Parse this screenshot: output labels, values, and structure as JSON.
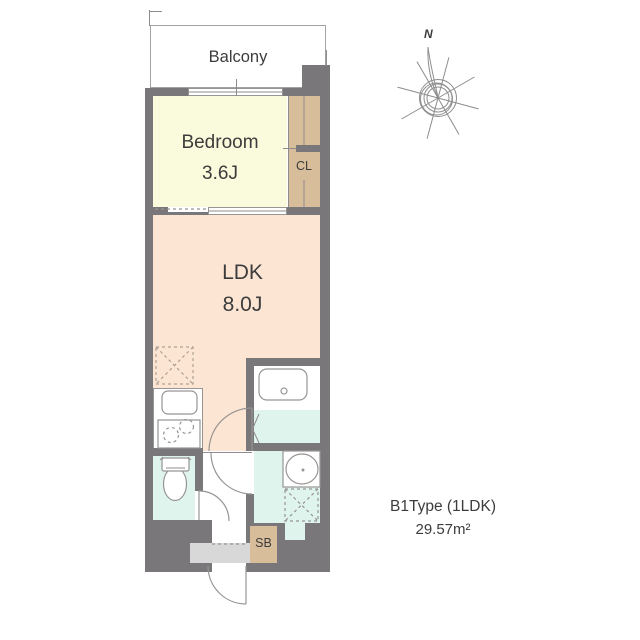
{
  "plan": {
    "balcony_label": "Balcony",
    "bedroom_label": "Bedroom",
    "bedroom_size": "3.6J",
    "ldk_label": "LDK",
    "ldk_size": "8.0J",
    "closet_label": "CL",
    "shoebox_label": "SB",
    "compass_label": "N",
    "type_label": "B1Type (1LDK)",
    "area_label": "29.57m²"
  },
  "colors": {
    "wall": "#79777a",
    "bedroom": "#fafadc",
    "ldk": "#fce5d3",
    "wet": "#e0f4ee",
    "storage": "#d8bd9b",
    "porch": "#d8d8d8",
    "outline": "#979593",
    "text": "#3c3c3c"
  }
}
